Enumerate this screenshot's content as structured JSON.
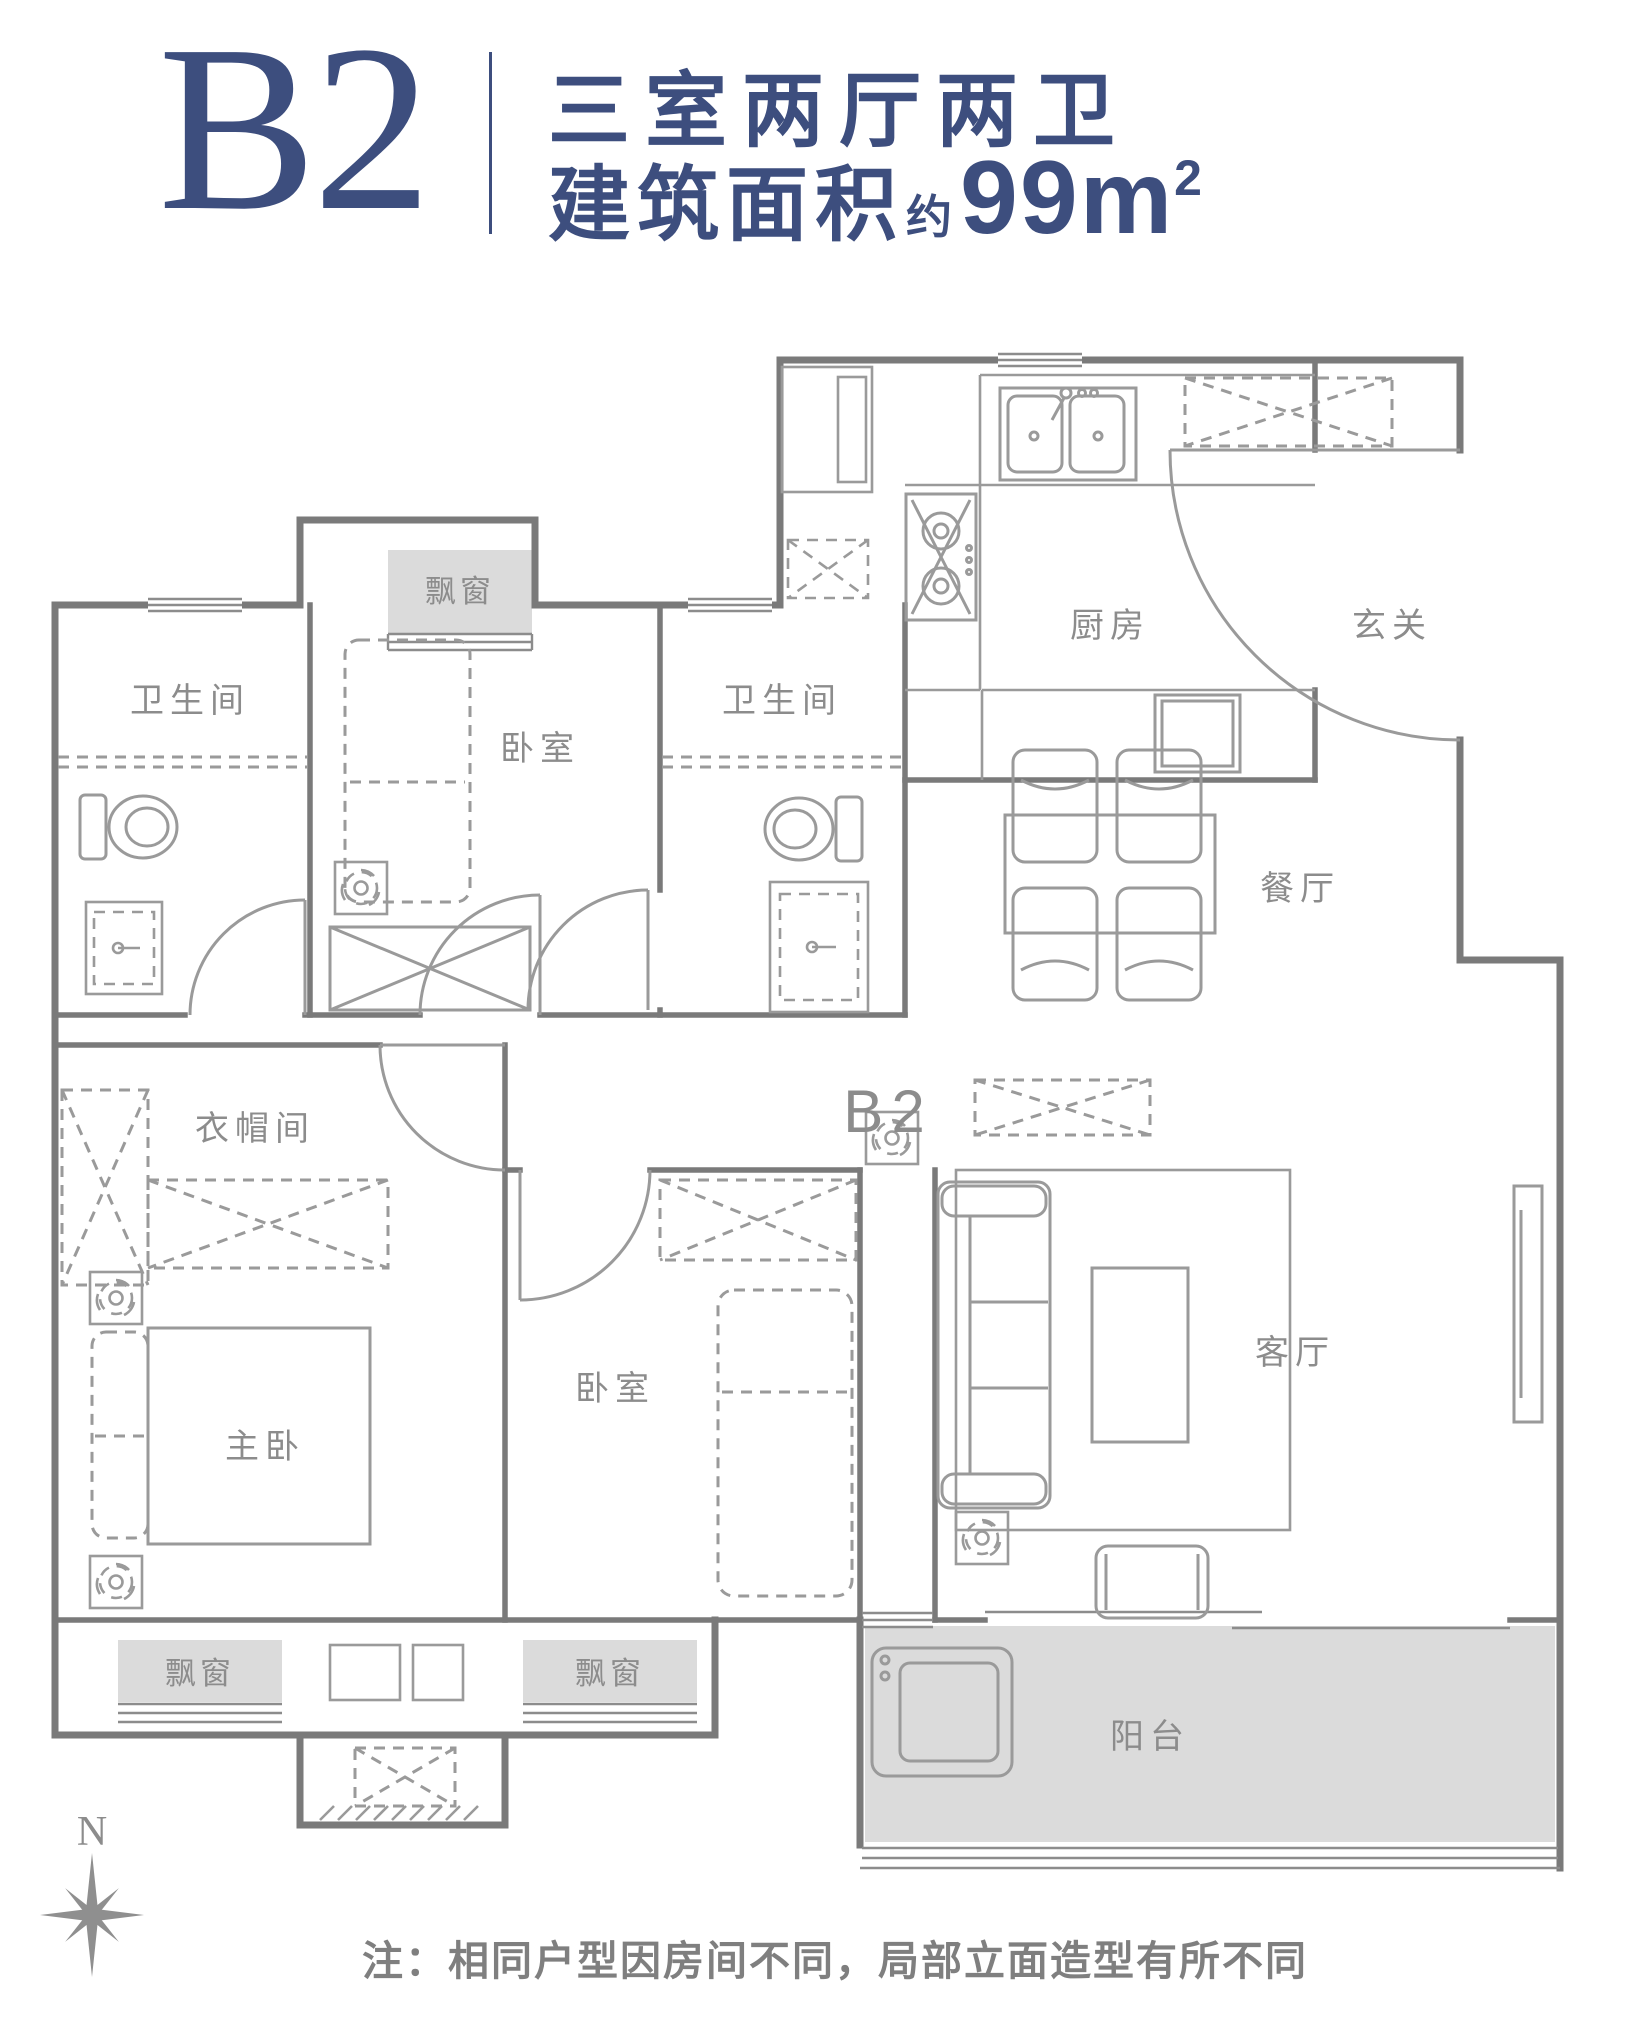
{
  "header": {
    "plan_code": "B2",
    "title": "三室两厅两卫",
    "area_prefix": "建筑面积",
    "area_approx": "约",
    "area_value": "99m",
    "area_superscript": "2"
  },
  "plan": {
    "center_label": "B2",
    "compass_north": "N",
    "note": "注：相同户型因房间不同，局部立面造型有所不同",
    "rooms": {
      "bathroom_top": "卫生间",
      "bedroom_top": "卧室",
      "bathroom_mid": "卫生间",
      "kitchen": "厨房",
      "foyer": "玄关",
      "dining": "餐厅",
      "cloakroom": "衣帽间",
      "master_bedroom": "主卧",
      "bedroom_bottom": "卧室",
      "living_room": "客厅",
      "balcony": "阳台"
    },
    "bay_windows": [
      "飘窗",
      "飘窗",
      "飘窗"
    ]
  },
  "colors": {
    "accent": "#3D4E7E",
    "wall": "#7A7A7A",
    "shade": "#DBDBDB",
    "label": "#8C8C8C"
  }
}
